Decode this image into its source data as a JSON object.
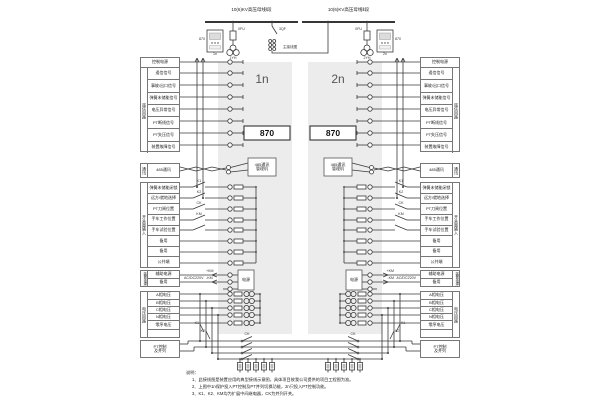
{
  "top": {
    "bus1": "10(6)KV高压母线Ⅰ段",
    "bus2": "10(6)KV高压母线Ⅱ段",
    "fuse1": "0FU",
    "fuse2": "0FU",
    "tie": "3QF",
    "pt1": "1YH",
    "pt2": "2YH",
    "device1": "870",
    "device2": "870",
    "unit1": "1n",
    "unit2": "2n",
    "caption": "主接线图"
  },
  "panel": {
    "unit1": "1n",
    "unit2": "2n",
    "device": "870",
    "comm_line1": "485通讯",
    "comm_line2": "管理机",
    "power_box": "电源"
  },
  "groups": {
    "signal": {
      "vertical": "遥信回路",
      "header": "控制电源",
      "rows": [
        "遥信信号",
        "事故/出口信号",
        "弹簧未储能信号",
        "电压异常信号",
        "PT断线信号",
        "PT失压信号",
        "装置故障信号"
      ]
    },
    "comm": {
      "vertical": "通讯",
      "row": "485通讯"
    },
    "di": {
      "vertical": "开关量输入",
      "rows": [
        "弹簧未储能闭锁",
        "远方/就地选择",
        "PT刀闸位置",
        "手车工作位置",
        "手车试验位置",
        "备用",
        "备用",
        "公共端"
      ]
    },
    "power": {
      "vertical": "装置电源",
      "rows": [
        "辅助电源",
        "备用"
      ],
      "ext": "AC/DC220V",
      "plus": "+KM",
      "minus": "-KM"
    },
    "voltage": {
      "vertical": "电压回路",
      "rows": [
        "A相电压",
        "B相电压",
        "C相电压",
        "N相电压",
        "零序电压"
      ]
    },
    "ptctrl": {
      "line1": "PT控制",
      "line2": "及并列"
    }
  },
  "contacts": {
    "di": [
      "K1",
      "K2",
      "CK",
      "KM"
    ],
    "ck": "CK",
    "k1": "K1",
    "k2": "K2"
  },
  "notes": {
    "heading": "说明：",
    "items": [
      "1、此接线图是装置应用的典型接线示意图，具体项目按我公司提供的项目工程图为准。",
      "2、上图中1n保护投入PT控制及PT并列切换功能，2n只投入PT控制功能。",
      "3、K1、K2、KM均为扩展中间继电器，CK为并列开关。"
    ]
  }
}
